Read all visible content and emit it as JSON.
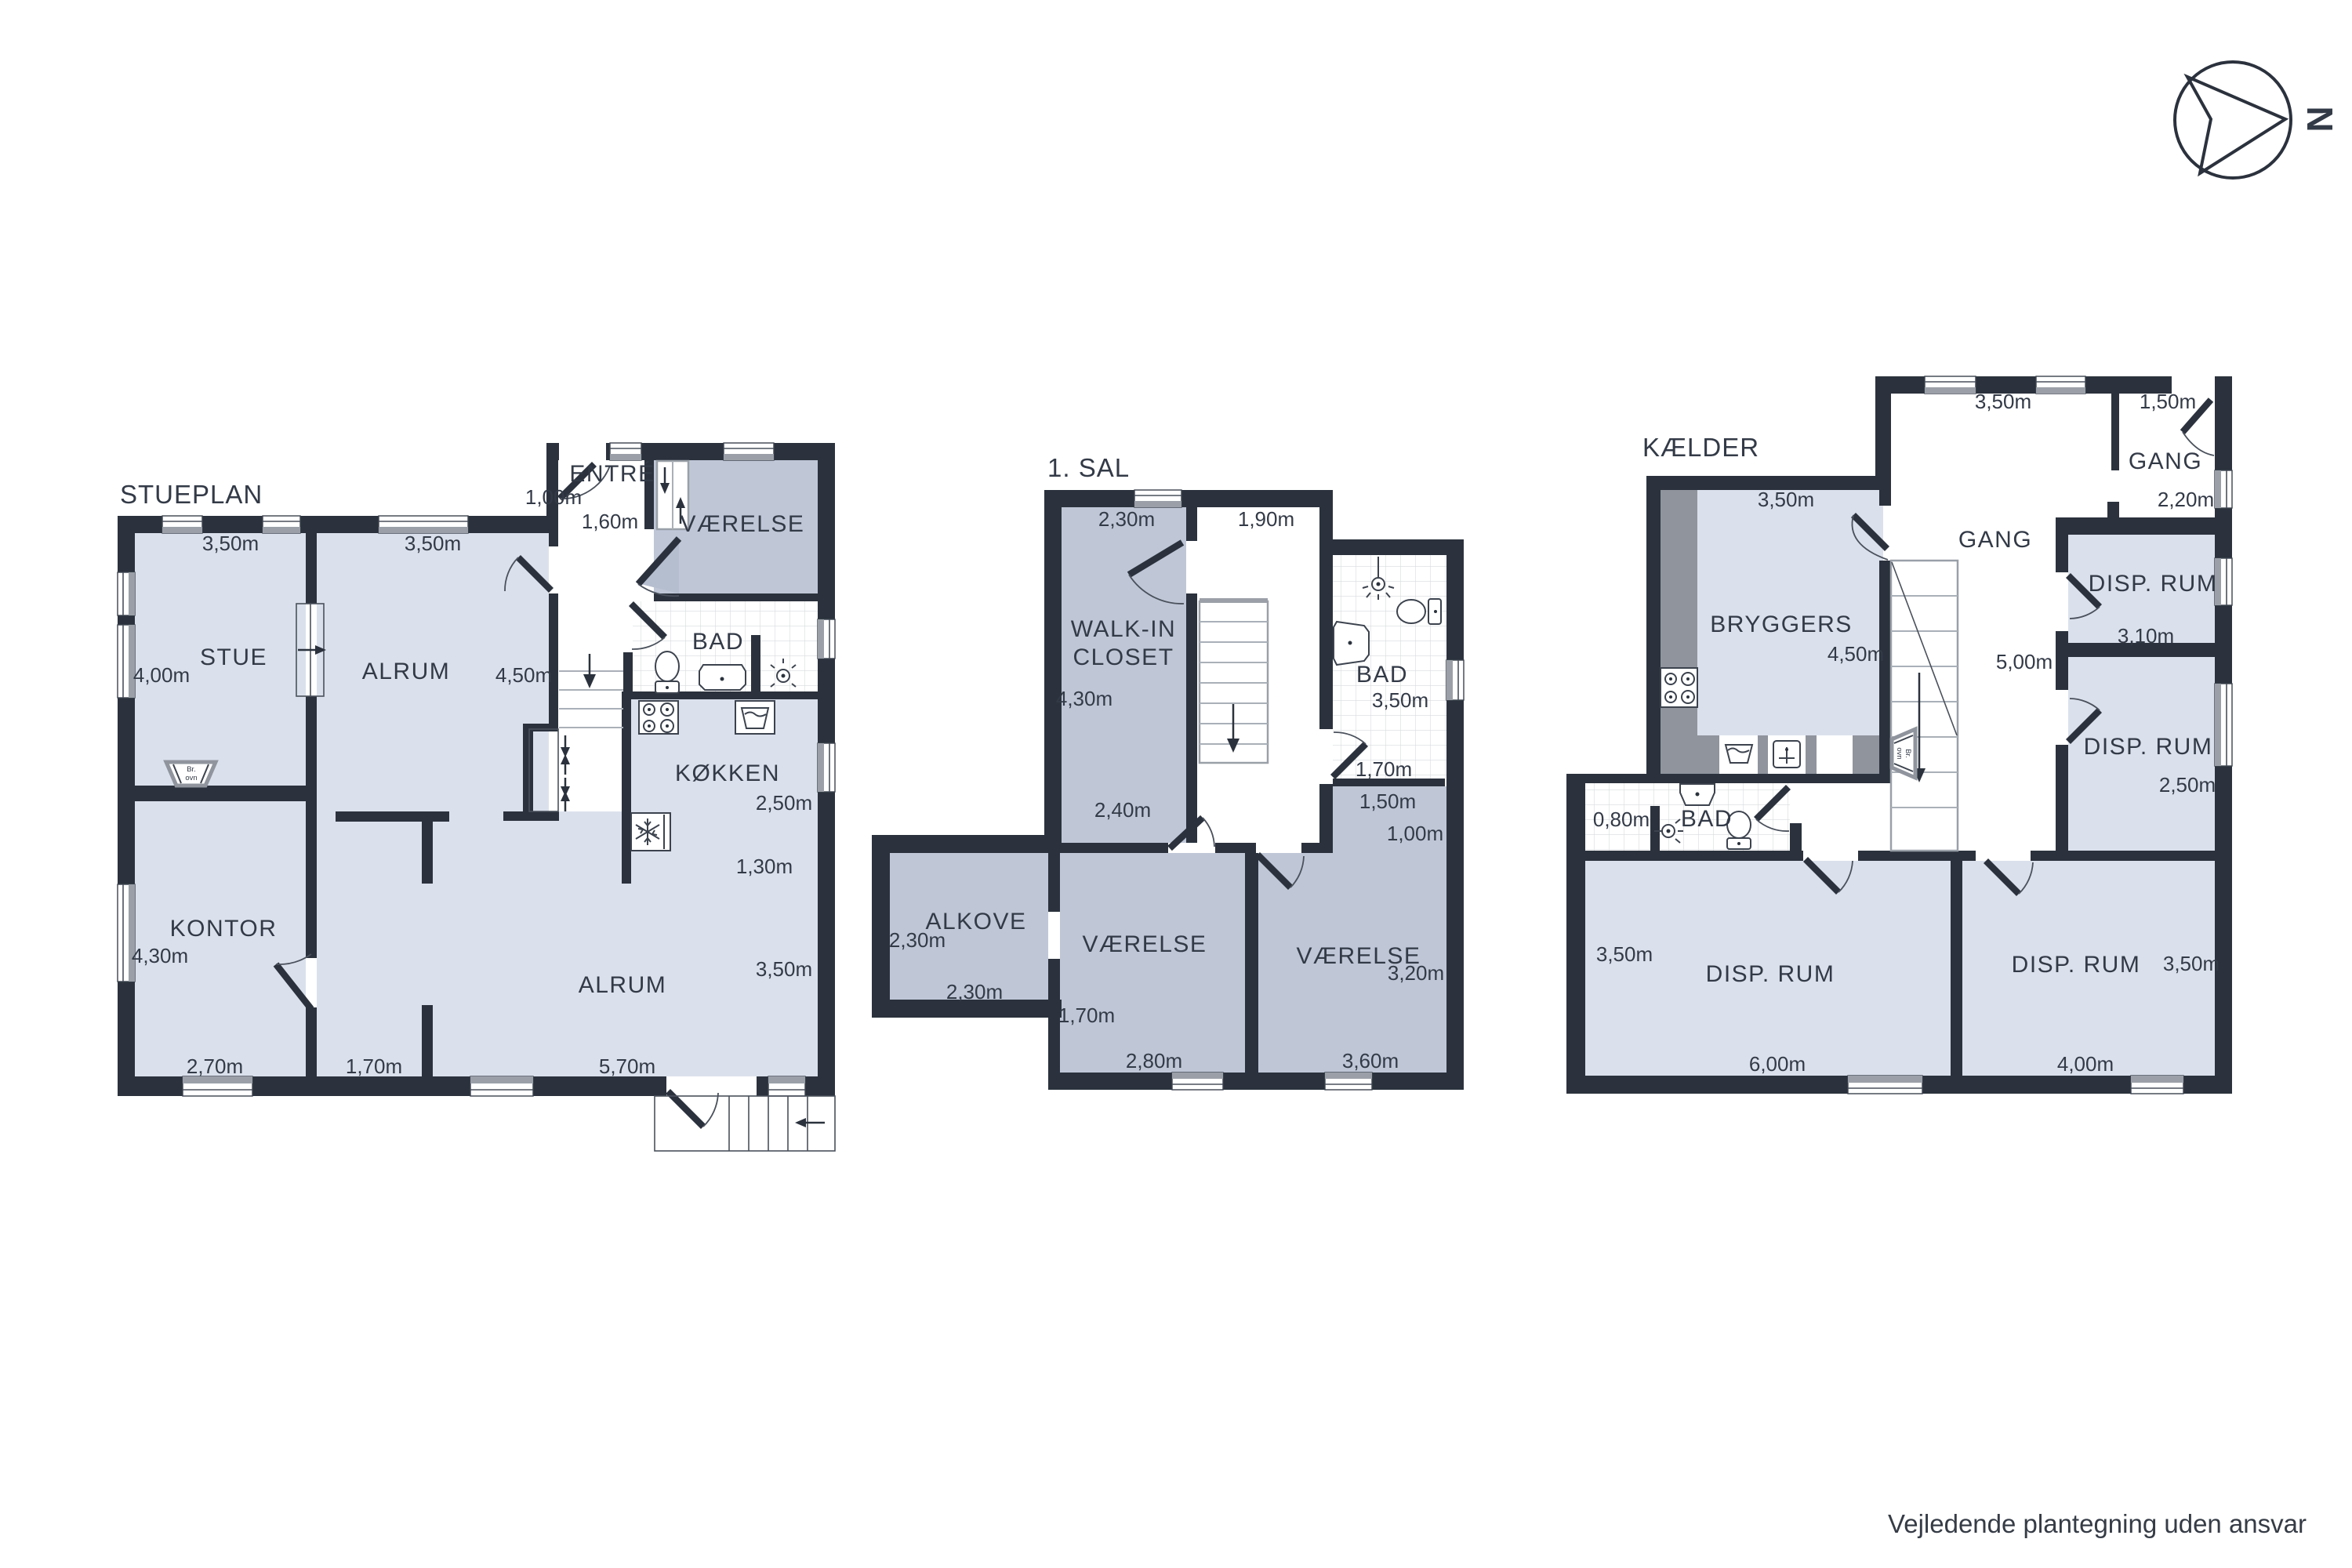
{
  "page": {
    "disclaimer": "Vejledende plantegning uden ansvar",
    "compass": {
      "label": "N"
    }
  },
  "colors": {
    "wall": "#2b323d",
    "room_light": "#dbe1ec",
    "room_dark": "#bfc7d7",
    "counter": "#8f949d",
    "window_inner": "#9ba0a8",
    "tile_line": "#d8dadd",
    "label": "#333a47"
  },
  "stueplan": {
    "title": "STUEPLAN",
    "rooms": {
      "stue": "STUE",
      "alrum_top": "ALRUM",
      "entre": "ENTRÉ",
      "vaerelse": "VÆRELSE",
      "bad": "BAD",
      "koekken": "KØKKEN",
      "kontor": "KONTOR",
      "alrum": "ALRUM"
    },
    "wood_stove": {
      "l1": "Br.",
      "l2": "ovn"
    },
    "m": {
      "stue_top": "3,50m",
      "alrum_top": "3,50m",
      "entre_door": "1,00m",
      "entre": "1,60m",
      "stue_left": "4,00m",
      "alrum_right": "4,50m",
      "koekken_right": "2,50m",
      "koekken_counter": "1,30m",
      "kontor_left": "4,30m",
      "kontor_bottom": "2,70m",
      "nook_bottom": "1,70m",
      "alrum_bottom": "5,70m",
      "alrum_right2": "3,50m"
    }
  },
  "sal": {
    "title": "1. SAL",
    "rooms": {
      "walkin_l1": "WALK-IN",
      "walkin_l2": "CLOSET",
      "bad": "BAD",
      "alkove": "ALKOVE",
      "vaerelse1": "VÆRELSE",
      "vaerelse2": "VÆRELSE"
    },
    "m": {
      "walkin_top": "2,30m",
      "landing_top": "1,90m",
      "walkin_left": "4,30m",
      "walkin_bottom": "2,40m",
      "bad_right": "3,50m",
      "bad_bottom": "1,70m",
      "niche_top": "1,50m",
      "niche": "1,00m",
      "alkove_left": "2,30m",
      "alkove_bottom": "2,30m",
      "vaerelse1_left": "1,70m",
      "vaerelse1_bottom": "2,80m",
      "vaerelse2_bottom": "3,60m",
      "vaerelse2_right": "3,20m"
    }
  },
  "kaelder": {
    "title": "KÆLDER",
    "rooms": {
      "bryggers": "BRYGGERS",
      "gang_top": "GANG",
      "gang": "GANG",
      "disp_tr": "DISP. RUM",
      "disp_mr": "DISP. RUM",
      "disp_bl": "DISP. RUM",
      "disp_br": "DISP. RUM",
      "bad": "BAD"
    },
    "wood_stove": {
      "l1": "Br.",
      "l2": "ovn"
    },
    "m": {
      "gang_top": "3,50m",
      "door_top": "1,50m",
      "gang_right": "2,20m",
      "bryggers_top": "3,50m",
      "bryggers_right": "4,50m",
      "gang_height": "5,00m",
      "disp_tr_bottom": "3,10m",
      "disp_mr_right": "2,50m",
      "bad_niche": "0,80m",
      "disp_bl_left": "3,50m",
      "disp_bl_bottom": "6,00m",
      "disp_br_bottom": "4,00m",
      "disp_br_right": "3,50m"
    }
  }
}
